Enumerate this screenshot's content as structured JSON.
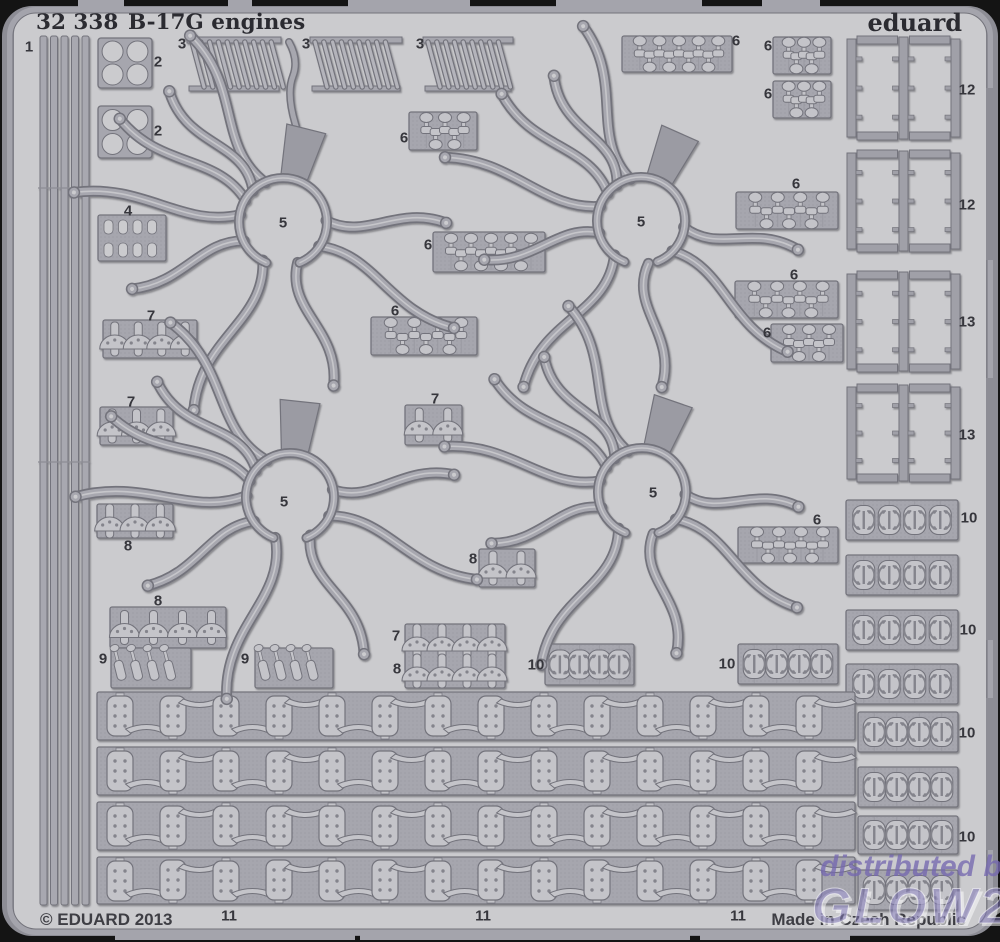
{
  "header": {
    "catalog_number": "32 338",
    "product_title": "B-17G engines",
    "brand": "eduard"
  },
  "footer": {
    "copyright": "© EDUARD 2013",
    "origin": "Made in Czech Republic"
  },
  "watermark": {
    "line1": "distributed by",
    "line2": "GLOW2B"
  },
  "colors": {
    "background": "#141414",
    "sheet": "#cbcbce",
    "sheet_edge": "#8d8d95",
    "frame_rail": "#a4a4ac",
    "plate": "#a6a6ae",
    "part_fill": "#c4c4c9",
    "part_outline": "#73737b",
    "detail": "#84848c",
    "label_text": "#36363c",
    "header_text": "#2b2b31",
    "watermark_purple": "#7e72b5"
  },
  "part_labels": [
    {
      "n": "1",
      "x": 29,
      "y": 47
    },
    {
      "n": "2",
      "x": 158,
      "y": 62
    },
    {
      "n": "2",
      "x": 158,
      "y": 131
    },
    {
      "n": "3",
      "x": 182,
      "y": 44
    },
    {
      "n": "3",
      "x": 306,
      "y": 44
    },
    {
      "n": "3",
      "x": 420,
      "y": 44
    },
    {
      "n": "4",
      "x": 128,
      "y": 211
    },
    {
      "n": "5",
      "x": 283,
      "y": 223
    },
    {
      "n": "5",
      "x": 641,
      "y": 222
    },
    {
      "n": "5",
      "x": 284,
      "y": 502
    },
    {
      "n": "5",
      "x": 653,
      "y": 493
    },
    {
      "n": "6",
      "x": 736,
      "y": 41
    },
    {
      "n": "6",
      "x": 768,
      "y": 46
    },
    {
      "n": "6",
      "x": 768,
      "y": 94
    },
    {
      "n": "6",
      "x": 404,
      "y": 138
    },
    {
      "n": "6",
      "x": 428,
      "y": 245
    },
    {
      "n": "6",
      "x": 796,
      "y": 184
    },
    {
      "n": "6",
      "x": 794,
      "y": 275
    },
    {
      "n": "6",
      "x": 767,
      "y": 333
    },
    {
      "n": "6",
      "x": 395,
      "y": 311
    },
    {
      "n": "6",
      "x": 817,
      "y": 520
    },
    {
      "n": "7",
      "x": 151,
      "y": 316
    },
    {
      "n": "7",
      "x": 131,
      "y": 402
    },
    {
      "n": "7",
      "x": 435,
      "y": 399
    },
    {
      "n": "7",
      "x": 396,
      "y": 636
    },
    {
      "n": "8",
      "x": 128,
      "y": 546
    },
    {
      "n": "8",
      "x": 158,
      "y": 601
    },
    {
      "n": "8",
      "x": 473,
      "y": 559
    },
    {
      "n": "8",
      "x": 397,
      "y": 669
    },
    {
      "n": "9",
      "x": 103,
      "y": 659
    },
    {
      "n": "9",
      "x": 245,
      "y": 659
    },
    {
      "n": "10",
      "x": 536,
      "y": 665
    },
    {
      "n": "10",
      "x": 727,
      "y": 664
    },
    {
      "n": "10",
      "x": 969,
      "y": 518
    },
    {
      "n": "10",
      "x": 968,
      "y": 630
    },
    {
      "n": "10",
      "x": 967,
      "y": 733
    },
    {
      "n": "10",
      "x": 967,
      "y": 837
    },
    {
      "n": "11",
      "x": 229,
      "y": 916
    },
    {
      "n": "11",
      "x": 483,
      "y": 916
    },
    {
      "n": "11",
      "x": 738,
      "y": 916
    },
    {
      "n": "12",
      "x": 967,
      "y": 90
    },
    {
      "n": "12",
      "x": 967,
      "y": 205
    },
    {
      "n": "13",
      "x": 967,
      "y": 322
    },
    {
      "n": "13",
      "x": 967,
      "y": 435
    }
  ]
}
